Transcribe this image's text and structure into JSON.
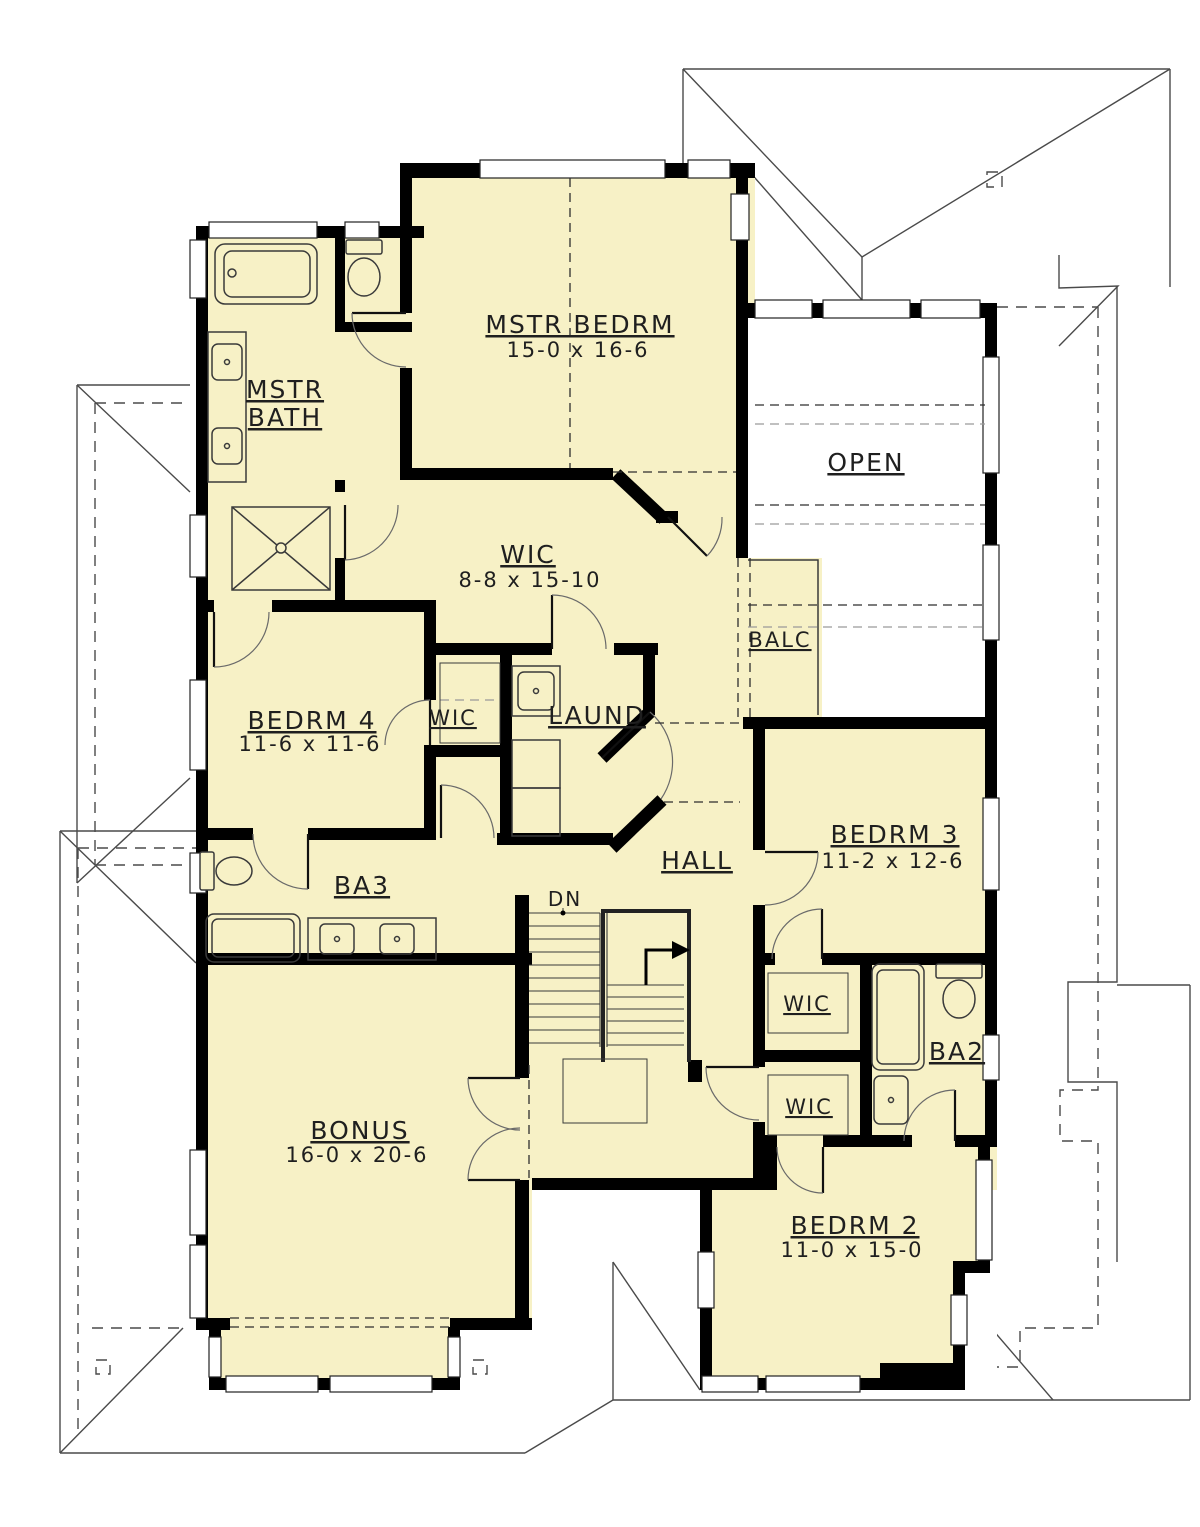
{
  "colors": {
    "room_fill": "#F7F1C6",
    "open_fill": "#FFFFFF",
    "wall": "#000000",
    "roof_line": "#4A4A4A",
    "label": "#1F1F1F"
  },
  "rooms": {
    "mstr_bedrm": {
      "label": "MSTR BEDRM",
      "dims": "15-0 x 16-6"
    },
    "mstr_bath": {
      "line1": "MSTR",
      "line2": "BATH"
    },
    "wic_master": {
      "label": "WIC",
      "dims": "8-8 x 15-10"
    },
    "open": {
      "label": "OPEN"
    },
    "balc": {
      "label": "BALC"
    },
    "bedrm4": {
      "label": "BEDRM 4",
      "dims": "11-6 x 11-6"
    },
    "wic_hall": {
      "label": "WIC"
    },
    "laund": {
      "label": "LAUND"
    },
    "hall": {
      "label": "HALL"
    },
    "bedrm3": {
      "label": "BEDRM 3",
      "dims": "11-2 x 12-6"
    },
    "ba3": {
      "label": "BA3"
    },
    "stairs": {
      "label": "DN"
    },
    "wic_bedrm3": {
      "label": "WIC"
    },
    "wic_bedrm2": {
      "label": "WIC"
    },
    "ba2": {
      "label": "BA2"
    },
    "bonus": {
      "label": "BONUS",
      "dims": "16-0 x 20-6"
    },
    "bedrm2": {
      "label": "BEDRM 2",
      "dims": "11-0 x 15-0"
    }
  }
}
